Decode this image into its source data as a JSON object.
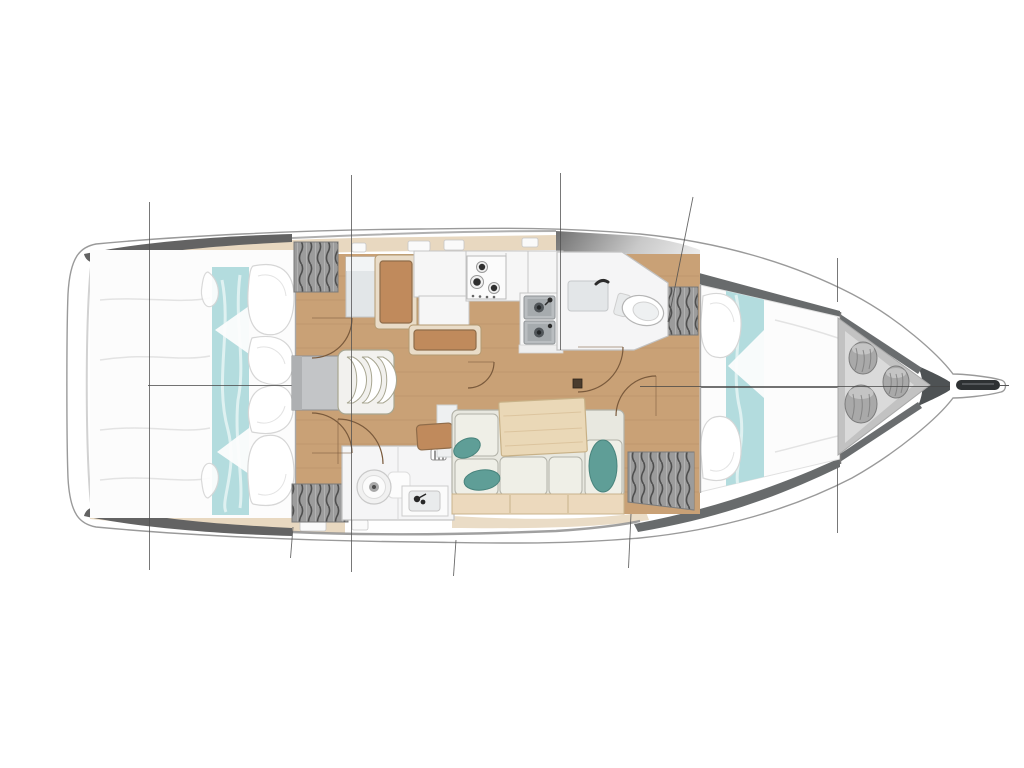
{
  "diagram": {
    "label": "Top-down interior layout plan of a sailing yacht, bow pointing right",
    "type": "floor-plan",
    "subject": "sailboat-interior-top-view",
    "orientation": {
      "bow": "right",
      "stern": "left"
    },
    "areas": [
      {
        "id": "aft-cabin-top",
        "label": "aft double berth with teal runner and pillows"
      },
      {
        "id": "aft-cabin-bottom",
        "label": "aft double berth with teal runner and pillows"
      },
      {
        "id": "companionway-steps",
        "label": "companionway steps with three treads"
      },
      {
        "id": "nav-station",
        "label": "navigation seat and chart table"
      },
      {
        "id": "galley",
        "label": "galley with three-burner stove and double sink"
      },
      {
        "id": "bathroom-top",
        "label": "mid head with toilet, basin and shower tray"
      },
      {
        "id": "bathroom-bottom",
        "label": "aft head with toilet and washbasin"
      },
      {
        "id": "saloon",
        "label": "saloon sofa with table and teal cushions"
      },
      {
        "id": "forward-cabin",
        "label": "forward V-berth with teal runner"
      },
      {
        "id": "sail-locker",
        "label": "bow sail locker with storage bags"
      },
      {
        "id": "bow-sprit",
        "label": "bow platform with anchor roller"
      }
    ],
    "station_lines_x": [
      149,
      351,
      560,
      837
    ],
    "rig_stay_line": {
      "from_x": 693,
      "from_y": 197,
      "to_x": 668,
      "to_y": 322
    }
  },
  "colors": {
    "bg": "#ffffff",
    "hull_line": "#9a9a9a",
    "hull_inner": "#d2d2d2",
    "deck_dark": "#636363",
    "wall_dark": "#5b5e60",
    "deck_tan": "#e8d8c0",
    "hatch_white": "#fafafa",
    "floor": "#c9a176",
    "floor_seam": "#a9845a",
    "bed_white": "#fcfcfc",
    "fold_line": "#e3e3e3",
    "pillow_line": "#d6d6d6",
    "teal": "#b3dcde",
    "teal_hi": "#e6f4f5",
    "bulkhead": "#a8a8a8",
    "furn_white": "#f6f6f6",
    "furn_line": "#c6c6c6",
    "orange": "#c08a5c",
    "orange_dark": "#8f6c4a",
    "frame_wood": "#e9dcc8",
    "frame_line": "#b49a72",
    "sofa": "#e8e8e0",
    "sofa_cell": "#efefe7",
    "sofa_line": "#b2b2a8",
    "bench": "#ecd9bd",
    "bench_line": "#c9b28c",
    "table": "#ead8b7",
    "table_line": "#c8b187",
    "pillow_teal": "#5f9e97",
    "pillow_teal_dark": "#48837c",
    "hatch_base": "#9c9c9c",
    "hatch_stroke": "#4f4f4f",
    "steel": "#b9bdc0",
    "steel_dark": "#34383a",
    "steps_fill": "#f2f1ee",
    "steps_line": "#a8a691",
    "box_grey": "#c3c5c7",
    "room_white": "#f5f5f6",
    "room_line": "#c2c2c2",
    "tray": "#e3e6e8",
    "locker_outer": "#c2c2c2",
    "locker_inner": "#dadada",
    "bag": "#a9a9a9",
    "bag_line": "#7c7c7c",
    "bag_top": "#c6c6c6",
    "anchor": "#2e3133",
    "arc": "#7a5a3c",
    "line_thin": "#4f4f4f",
    "center": "#454545",
    "cab_pale": "#e2e6e8",
    "patch_dark": "#707070",
    "patch_mid": "#c9c9c9"
  }
}
